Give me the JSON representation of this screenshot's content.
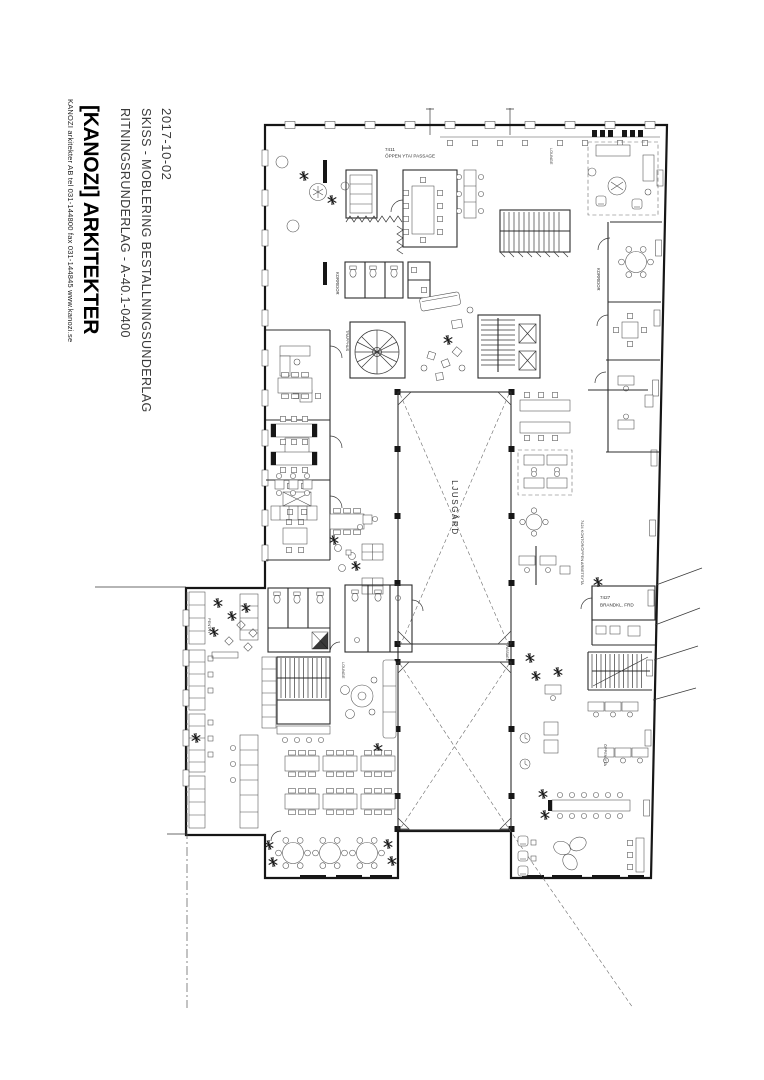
{
  "titleblock": {
    "date": "2017-10-02",
    "subtitle1": "SKISS - MOBLERING BESTALLNINGSUNDERLAG",
    "subtitle2": "RITNINGSRUNDERLAG - A-40.1-0400",
    "logo": "[KANOZI] ARKITEKTER",
    "contact": "KANOZI arkitekter AB  tel 031-144800  fax 031-144845  www.kanozi.se"
  },
  "plan": {
    "labels": {
      "open_area_no": "7411",
      "open_area": "ÖPPEN YTA/ PASSAGE",
      "courtyard": "LJUSGÅRD",
      "fire_storage_no": "7427",
      "fire_storage": "BRANDKL. FRD",
      "corridor": "KORRIDOR",
      "stairwell": "TRAPPHUS",
      "office_open": "7424  KONTOR/ÖPPEN ARBETSYTA",
      "open_space": "ÖPPEN YTA",
      "lounge": "LOUNGE",
      "pantry": "PENTRY",
      "passage": "PASSAGE"
    },
    "colors": {
      "ink": "#161616",
      "furniture": "#4d4d4d",
      "paper": "#ffffff"
    }
  }
}
